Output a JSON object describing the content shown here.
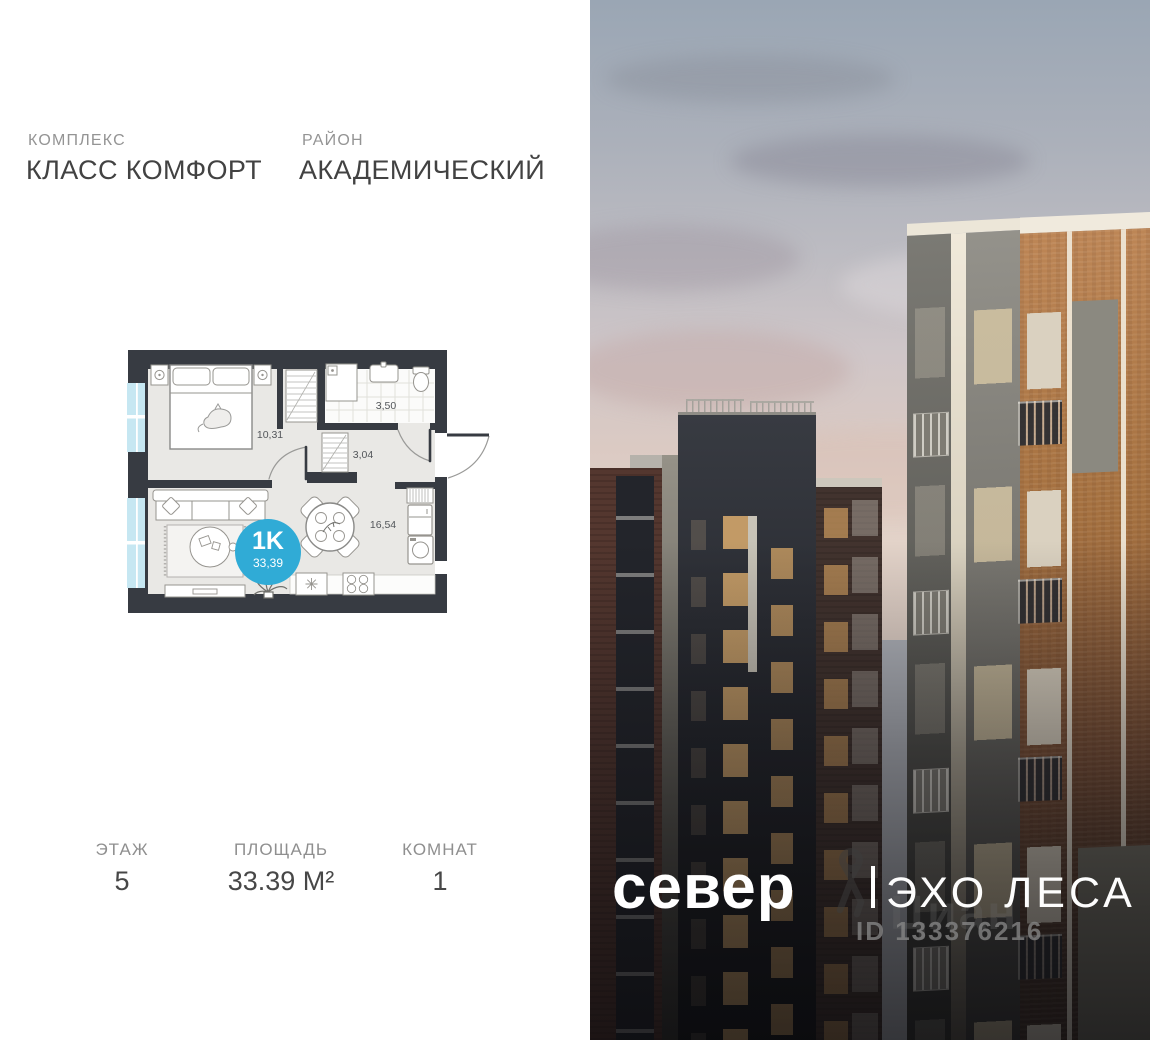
{
  "header": {
    "complex_label": "КОМПЛЕКС",
    "complex_name": "КЛАСС КОМФОРТ",
    "district_label": "РАЙОН",
    "district_name": "АКАДЕМИЧЕСКИЙ"
  },
  "floorplan": {
    "badge_type": "1K",
    "badge_area": "33,39",
    "accent_color": "#30abd6",
    "wall_color": "#373b42",
    "window_color": "#c6e7f2",
    "rooms": [
      {
        "name": "bedroom",
        "area": "10,31"
      },
      {
        "name": "bathroom",
        "area": "3,50"
      },
      {
        "name": "hallway",
        "area": "3,04"
      },
      {
        "name": "living-kitchen",
        "area": "16,54"
      }
    ]
  },
  "stats": {
    "floor": {
      "label": "ЭТАЖ",
      "value": "5"
    },
    "area": {
      "label": "ПЛОЩАДЬ",
      "value": "33.39 М²"
    },
    "rooms": {
      "label": "КОМНАТ",
      "value": "1"
    }
  },
  "photo": {
    "logo_left": "север",
    "logo_right": "ЭХО ЛЕСА",
    "watermark_brand": "Циан",
    "watermark_id": "ID 133376216"
  }
}
